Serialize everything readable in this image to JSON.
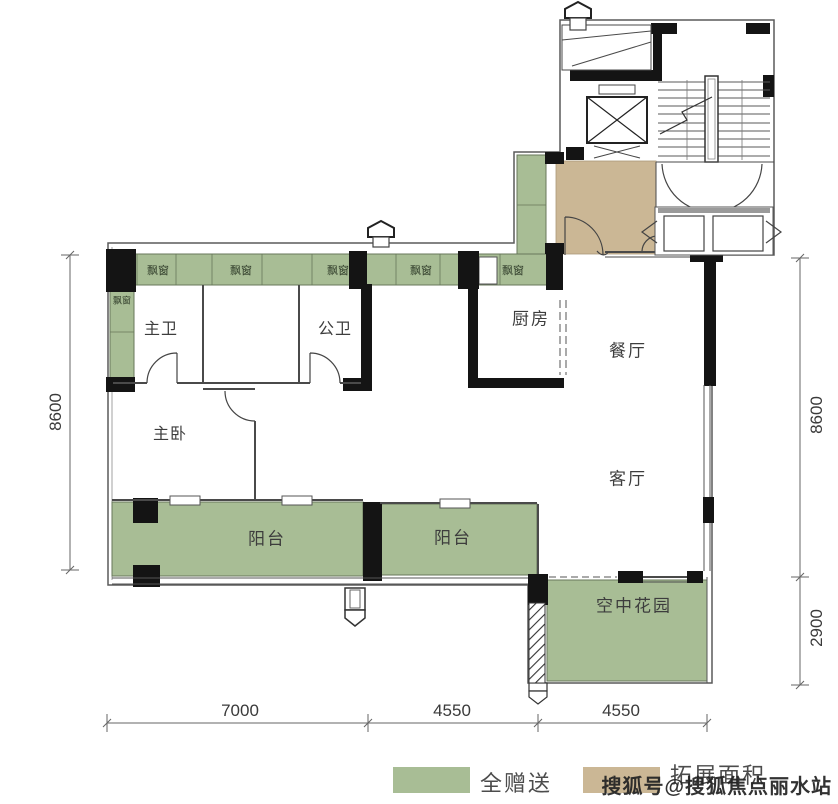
{
  "rooms": {
    "master_bath": "主卫",
    "public_bath": "公卫",
    "kitchen": "厨房",
    "dining": "餐厅",
    "living": "客厅",
    "master_bedroom": "主卧",
    "sky_garden": "空中花园",
    "balconies": [
      "阳台",
      "阳台"
    ]
  },
  "bay_windows": [
    "飘窗",
    "飘窗",
    "飘窗",
    "飘窗",
    "飘窗",
    "飘窗"
  ],
  "dimensions": {
    "left_vertical": "8600",
    "right_vertical_upper": "8600",
    "right_vertical_lower": "2900",
    "bottom_left": "7000",
    "bottom_middle": "4550",
    "bottom_right": "4550"
  },
  "legend": {
    "full_gift": "全赠送",
    "expansion_area": "拓展面积"
  },
  "watermark": "搜狐号@搜狐焦点丽水站",
  "colors": {
    "gift_green": "#a8bd95",
    "expansion_tan": "#cbb795",
    "wall_black": "#141414",
    "line_gray": "#555555"
  }
}
